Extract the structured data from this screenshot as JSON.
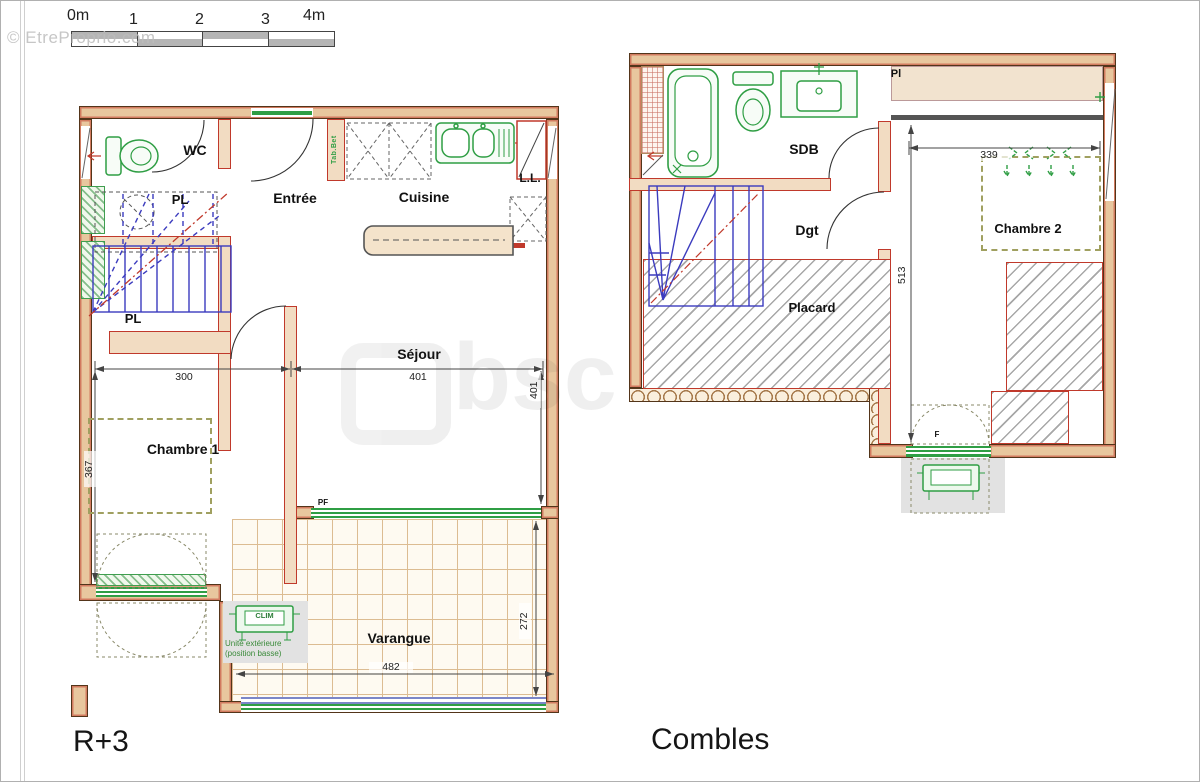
{
  "watermark": {
    "top_left": "© EtreProprio.com",
    "center": "bsc"
  },
  "scale_bar": {
    "unit_labels": [
      "0m",
      "1",
      "2",
      "3",
      "4m"
    ]
  },
  "floor1": {
    "title": "R+3",
    "labels": {
      "wc": "WC",
      "pl_top": "PL",
      "entree": "Entrée",
      "cuisine": "Cuisine",
      "tab": "Tab.Bet",
      "ll": "L.L.",
      "pl_bottom": "PL",
      "sejour": "Séjour",
      "chambre1": "Chambre 1",
      "varangue": "Varangue",
      "pf": "PF",
      "clim": "CLIM",
      "clim_note1": "Unité extérieure",
      "clim_note2": "(position basse)"
    },
    "dimensions": {
      "chambre1_width": "300",
      "sejour_width": "401",
      "sejour_height": "401",
      "chambre1_height": "367",
      "varangue_width": "482",
      "varangue_height": "272"
    }
  },
  "floor2": {
    "title": "Combles",
    "labels": {
      "sdb": "SDB",
      "pl": "Pl",
      "dgt": "Dgt",
      "placard": "Placard",
      "chambre2": "Chambre 2",
      "window_f": "F"
    },
    "dimensions": {
      "chambre2_width": "339",
      "chambre2_height": "513"
    }
  }
}
